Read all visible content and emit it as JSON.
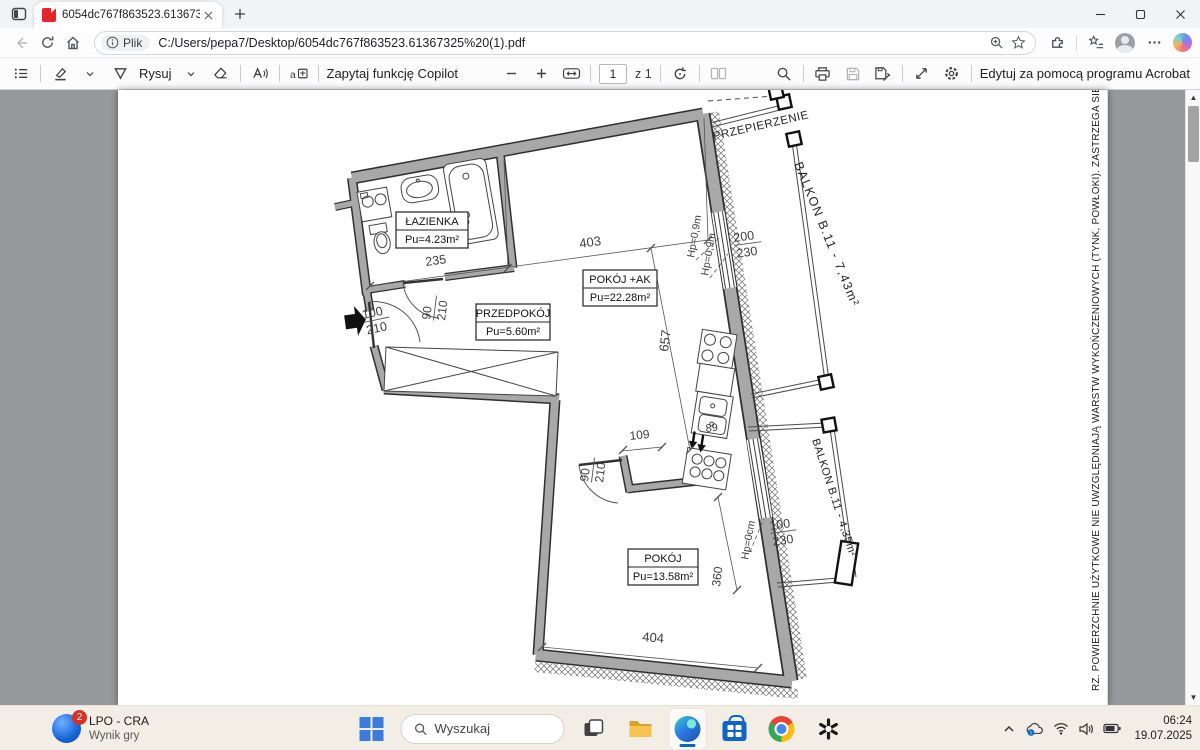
{
  "browser": {
    "tab_title": "6054dc767f863523.61367325 (1).pdf",
    "address": {
      "badge_label": "Plik",
      "url": "C:/Users/pepa7/Desktop/6054dc767f863523.61367325%20(1).pdf"
    }
  },
  "pdf_toolbar": {
    "draw_label": "Rysuj",
    "copilot_label": "Zapytaj funkcję Copilot",
    "page_value": "1",
    "page_count": "z 1",
    "acrobat_label": "Edytuj za pomocą programu Acrobat"
  },
  "plan": {
    "rooms": {
      "lazienka_name": "ŁAZIENKA",
      "lazienka_area": "Pu=4.23m²",
      "przedpokoj_name": "PRZEDPOKÓJ",
      "przedpokoj_area": "Pu=5.60m²",
      "pokoj_ak_name": "POKÓJ +AK",
      "pokoj_ak_area": "Pu=22.28m²",
      "pokoj_name": "POKÓJ",
      "pokoj_area": "Pu=13.58m²"
    },
    "balcony_1": "BALKON B.11 - 7,43m²",
    "balcony_2": "BALKON B.11 - 4,35m²",
    "partition": "PRZEPIERZENIE",
    "dims": {
      "d403": "403",
      "d235": "235",
      "d190": "190",
      "d657": "657",
      "d109": "109",
      "d89": "89",
      "d404": "404",
      "d360": "360",
      "win_w": "200",
      "win_h": "230",
      "bdoor_w": "100",
      "bdoor_h": "230",
      "entry_w": "100",
      "entry_h": "210",
      "bath_door_w": "90",
      "bath_door_h": "210",
      "room_door_w": "90",
      "room_door_h": "210",
      "hp_win_a": "Hp=0,9m",
      "hp_win_b": "Hp=0,9m",
      "hp_door": "Hp=0cm"
    },
    "side_note": "RZ. POWIERZCHNIE UŻYTKOWE NIE UWZGLĘDNIAJĄ WARSTW WYKOŃCZENIOWYCH (TYNK, POWŁOKI). ZASTRZEGA SIĘ MOŻLIWOŚĆ WPR"
  },
  "taskbar": {
    "widget_badge": "2",
    "widget_title": "LPO - CRA",
    "widget_subtitle": "Wynik gry",
    "search_placeholder": "Wyszukaj",
    "time": "06:24",
    "date": "19.07.2025"
  }
}
